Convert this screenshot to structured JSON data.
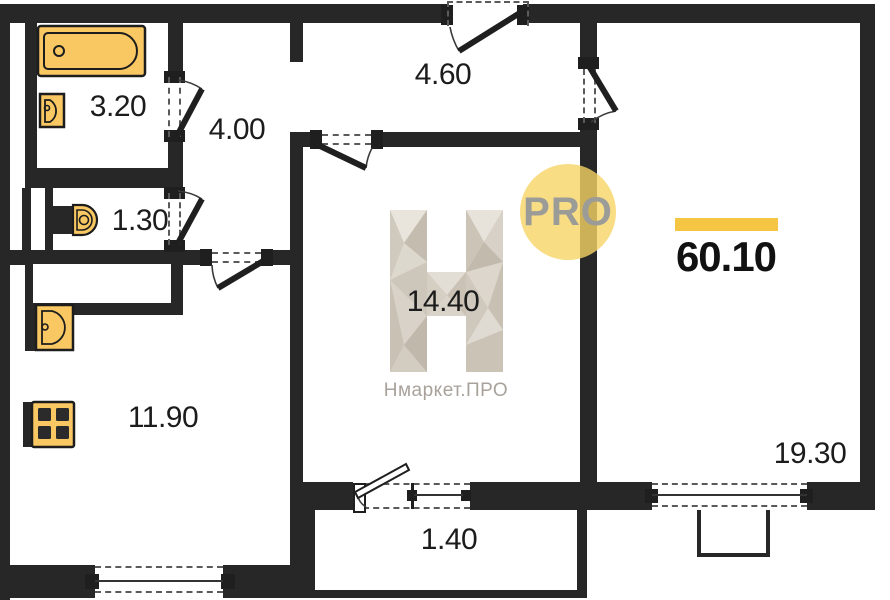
{
  "watermark": {
    "badge_label": "PRO",
    "brand_label": "Нмаркет.ПРО"
  },
  "summary": {
    "total_area": "60.10"
  },
  "rooms": {
    "bathroom": {
      "area": "3.20"
    },
    "hallway": {
      "area": "4.00"
    },
    "entry_hall": {
      "area": "4.60"
    },
    "toilet": {
      "area": "1.30"
    },
    "living_room": {
      "area": "14.40"
    },
    "kitchen": {
      "area": "11.90"
    },
    "balcony": {
      "area": "1.40"
    },
    "bedroom": {
      "area": "19.30"
    }
  },
  "fixtures": [
    "bathtub-icon",
    "bathroom-sink-icon",
    "toilet-icon",
    "kitchen-sink-icon",
    "stove-icon"
  ],
  "colors": {
    "wall": "#272727",
    "fixture_fill": "#F9C863",
    "accent_bar": "#F5C544",
    "badge_fill": "#F6D47A",
    "badge_text": "#9B9B98",
    "brand_text": "#A8A29B",
    "label_text": "#1C1C1C"
  }
}
